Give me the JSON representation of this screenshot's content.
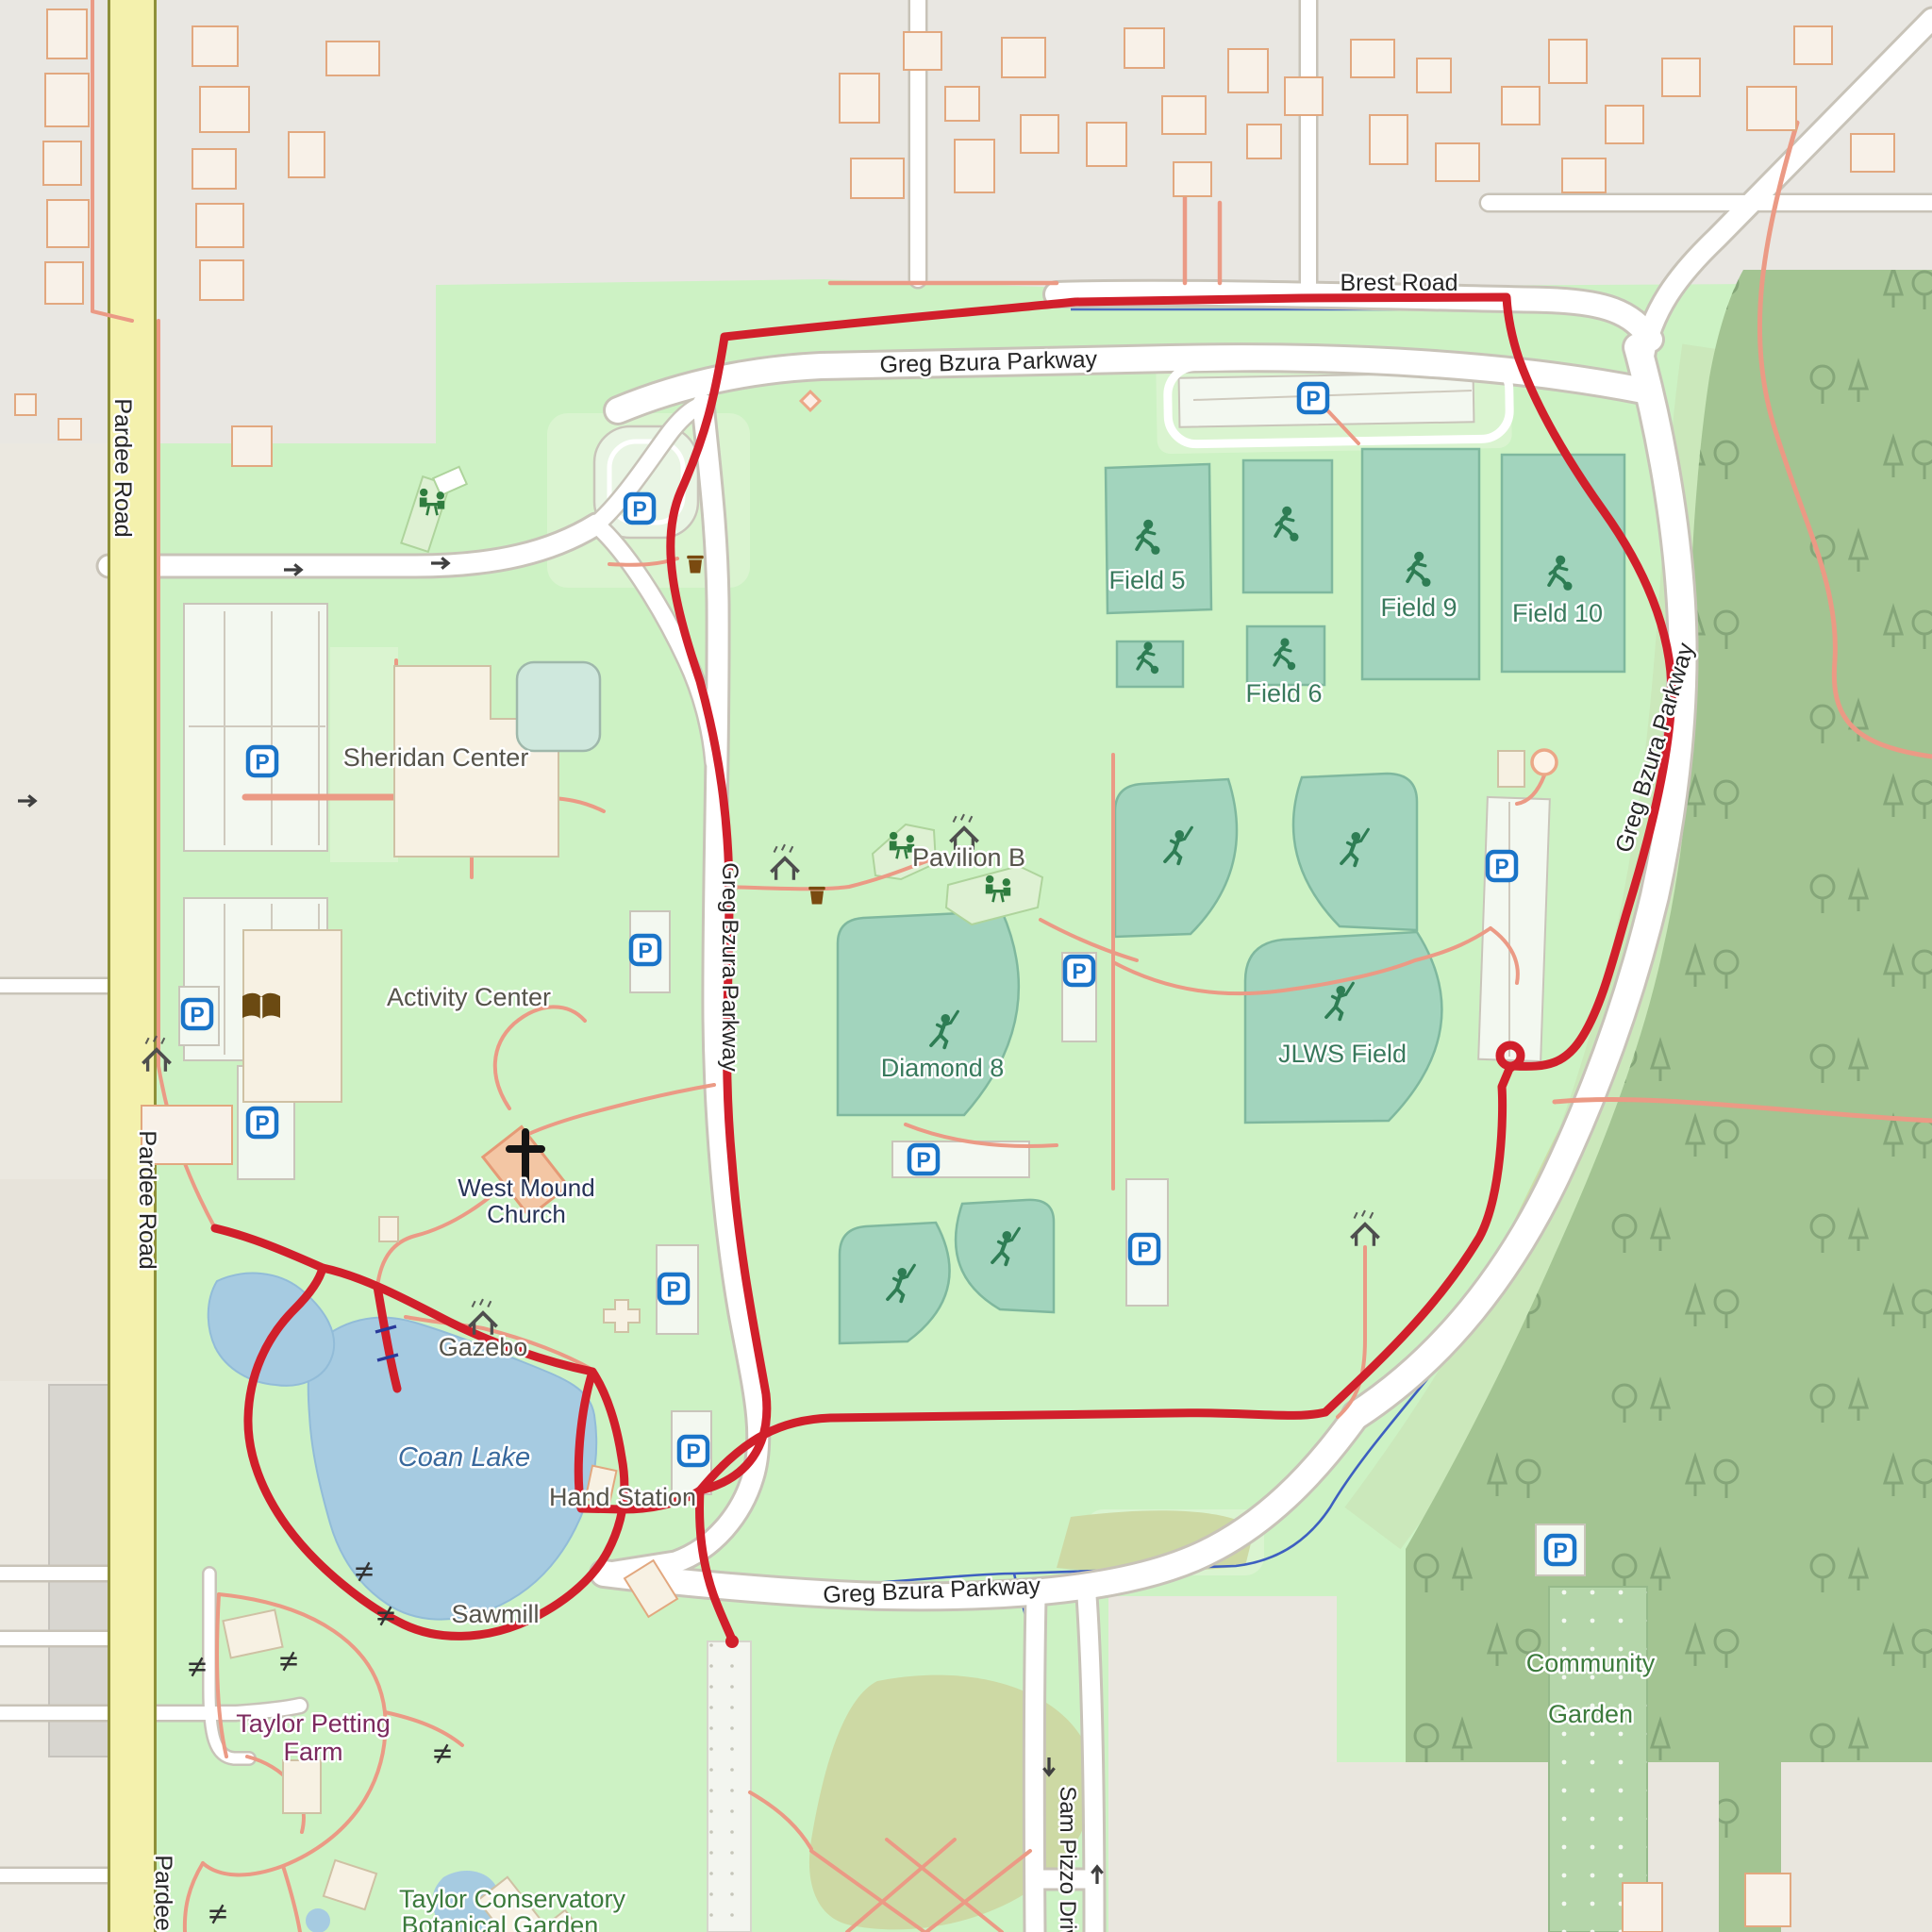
{
  "map": {
    "roads": {
      "pardee": "Pardee Road",
      "brest": "Brest Road",
      "greg_bzura": "Greg Bzura Parkway",
      "sam_pizzo": "Sam Pizzo Drive"
    },
    "places": {
      "sheridan": "Sheridan Center",
      "activity": "Activity Center",
      "church_line1": "West Mound",
      "church_line2": "Church",
      "gazebo": "Gazebo",
      "coan_lake": "Coan Lake",
      "hand_station": "Hand Station",
      "sawmill": "Sawmill",
      "farm_line1": "Taylor Petting",
      "farm_line2": "Farm",
      "garden_line1": "Community",
      "garden_line2": "Garden",
      "conservatory_line1": "Taylor Conservatory",
      "conservatory_line2": "Botanical Garden",
      "pavilion_b": "Pavilion B"
    },
    "sports": {
      "field5": "Field 5",
      "field6": "Field 6",
      "field9": "Field 9",
      "field10": "Field 10",
      "diamond8": "Diamond 8",
      "jlws": "JLWS Field"
    },
    "icons": {
      "parking_letter": "P",
      "semantic": [
        "parking-icon",
        "soccer-player-icon",
        "baseball-player-icon",
        "picnic-table-icon",
        "shelter-icon",
        "trash-icon",
        "drinking-fountain-icon",
        "library-book-icon",
        "church-cross-icon",
        "one-way-arrow-icon",
        "gate-icon",
        "tree-icon",
        "street-lamp-icon",
        "dam-icon"
      ]
    },
    "colors": {
      "route_track": "#d11f2b",
      "park_green": "#cdf2c4",
      "forest_green": "#a3c492",
      "sports_field": "#a2d4bd",
      "water": "#a6cbe1",
      "stream": "#3d5fc0",
      "parking_blue": "#1a74c8",
      "secondary_road_yellow": "#f4f1ad",
      "path_salmon": "#eb9a85",
      "urban_gray": "#e9e7e2"
    }
  }
}
